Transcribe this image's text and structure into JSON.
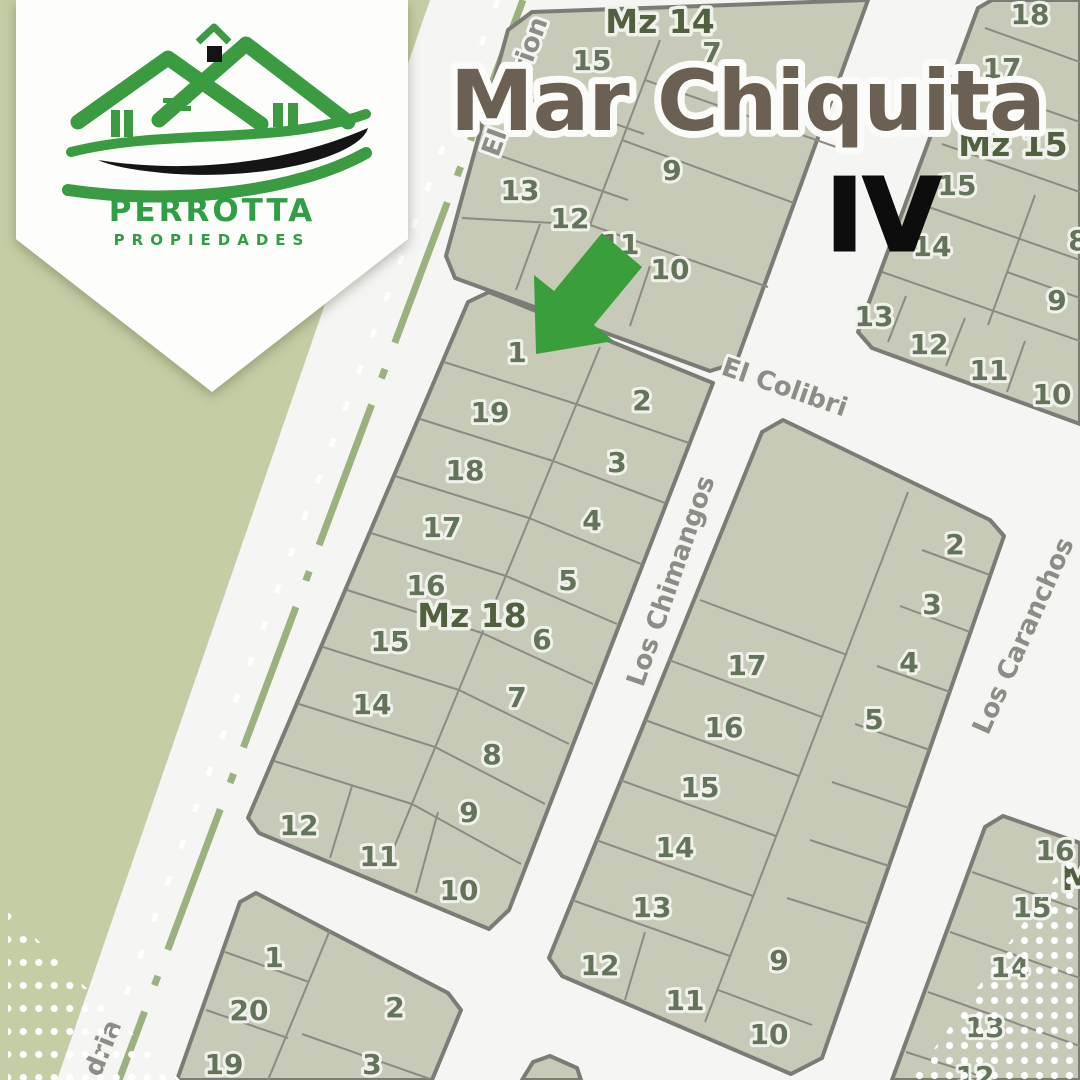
{
  "brand": {
    "name": "PERROTTA",
    "tagline": "PROPIEDADES"
  },
  "map": {
    "title": "Mar Chiquita",
    "stage": "IV",
    "streets": {
      "gorrion": "El Gorrion",
      "colibri": "El Colibri",
      "chimangos": "Los Chimangos",
      "caranchos": "Los Caranchos",
      "calandria_fragment": "dria"
    },
    "blocks": {
      "mz14": {
        "label": "Mz 14",
        "lots": [
          "15",
          "7",
          "9",
          "13",
          "12",
          "11",
          "10"
        ]
      },
      "mz15": {
        "label": "Mz 15",
        "lots": [
          "18",
          "17",
          "15",
          "14",
          "8",
          "9",
          "13",
          "12",
          "11",
          "10"
        ]
      },
      "mz18": {
        "label": "Mz 18",
        "lots": [
          "1",
          "19",
          "2",
          "18",
          "3",
          "17",
          "4",
          "16",
          "5",
          "15",
          "6",
          "14",
          "7",
          "8",
          "12",
          "9",
          "11",
          "10"
        ]
      },
      "east": {
        "label": "",
        "lots": [
          "2",
          "3",
          "4",
          "5",
          "17",
          "16",
          "15",
          "14",
          "13",
          "12",
          "11",
          "10",
          "9"
        ]
      },
      "south": {
        "label": "",
        "lots": [
          "1",
          "20",
          "2",
          "19",
          "3"
        ]
      },
      "southeast": {
        "label": "M",
        "lots": [
          "16",
          "15",
          "14",
          "13",
          "12"
        ]
      }
    },
    "marker": {
      "type": "arrow",
      "color": "#3a9e3a",
      "target_block": "Mz 18",
      "target_lot": "1"
    }
  },
  "colors": {
    "olive_terrain": "#c4cda4",
    "road": "#f5f5f3",
    "block_fill": "#c7cab7",
    "block_border": "#7c7c76",
    "lot_number": "#64745a",
    "mz_label": "#51613f",
    "street_label": "#8d8d87",
    "title": "#6b6052",
    "stage": "#0d0d0d",
    "median_dash": "#9cb27e",
    "logo_green": "#2f9e44",
    "dots": "#ffffff"
  }
}
